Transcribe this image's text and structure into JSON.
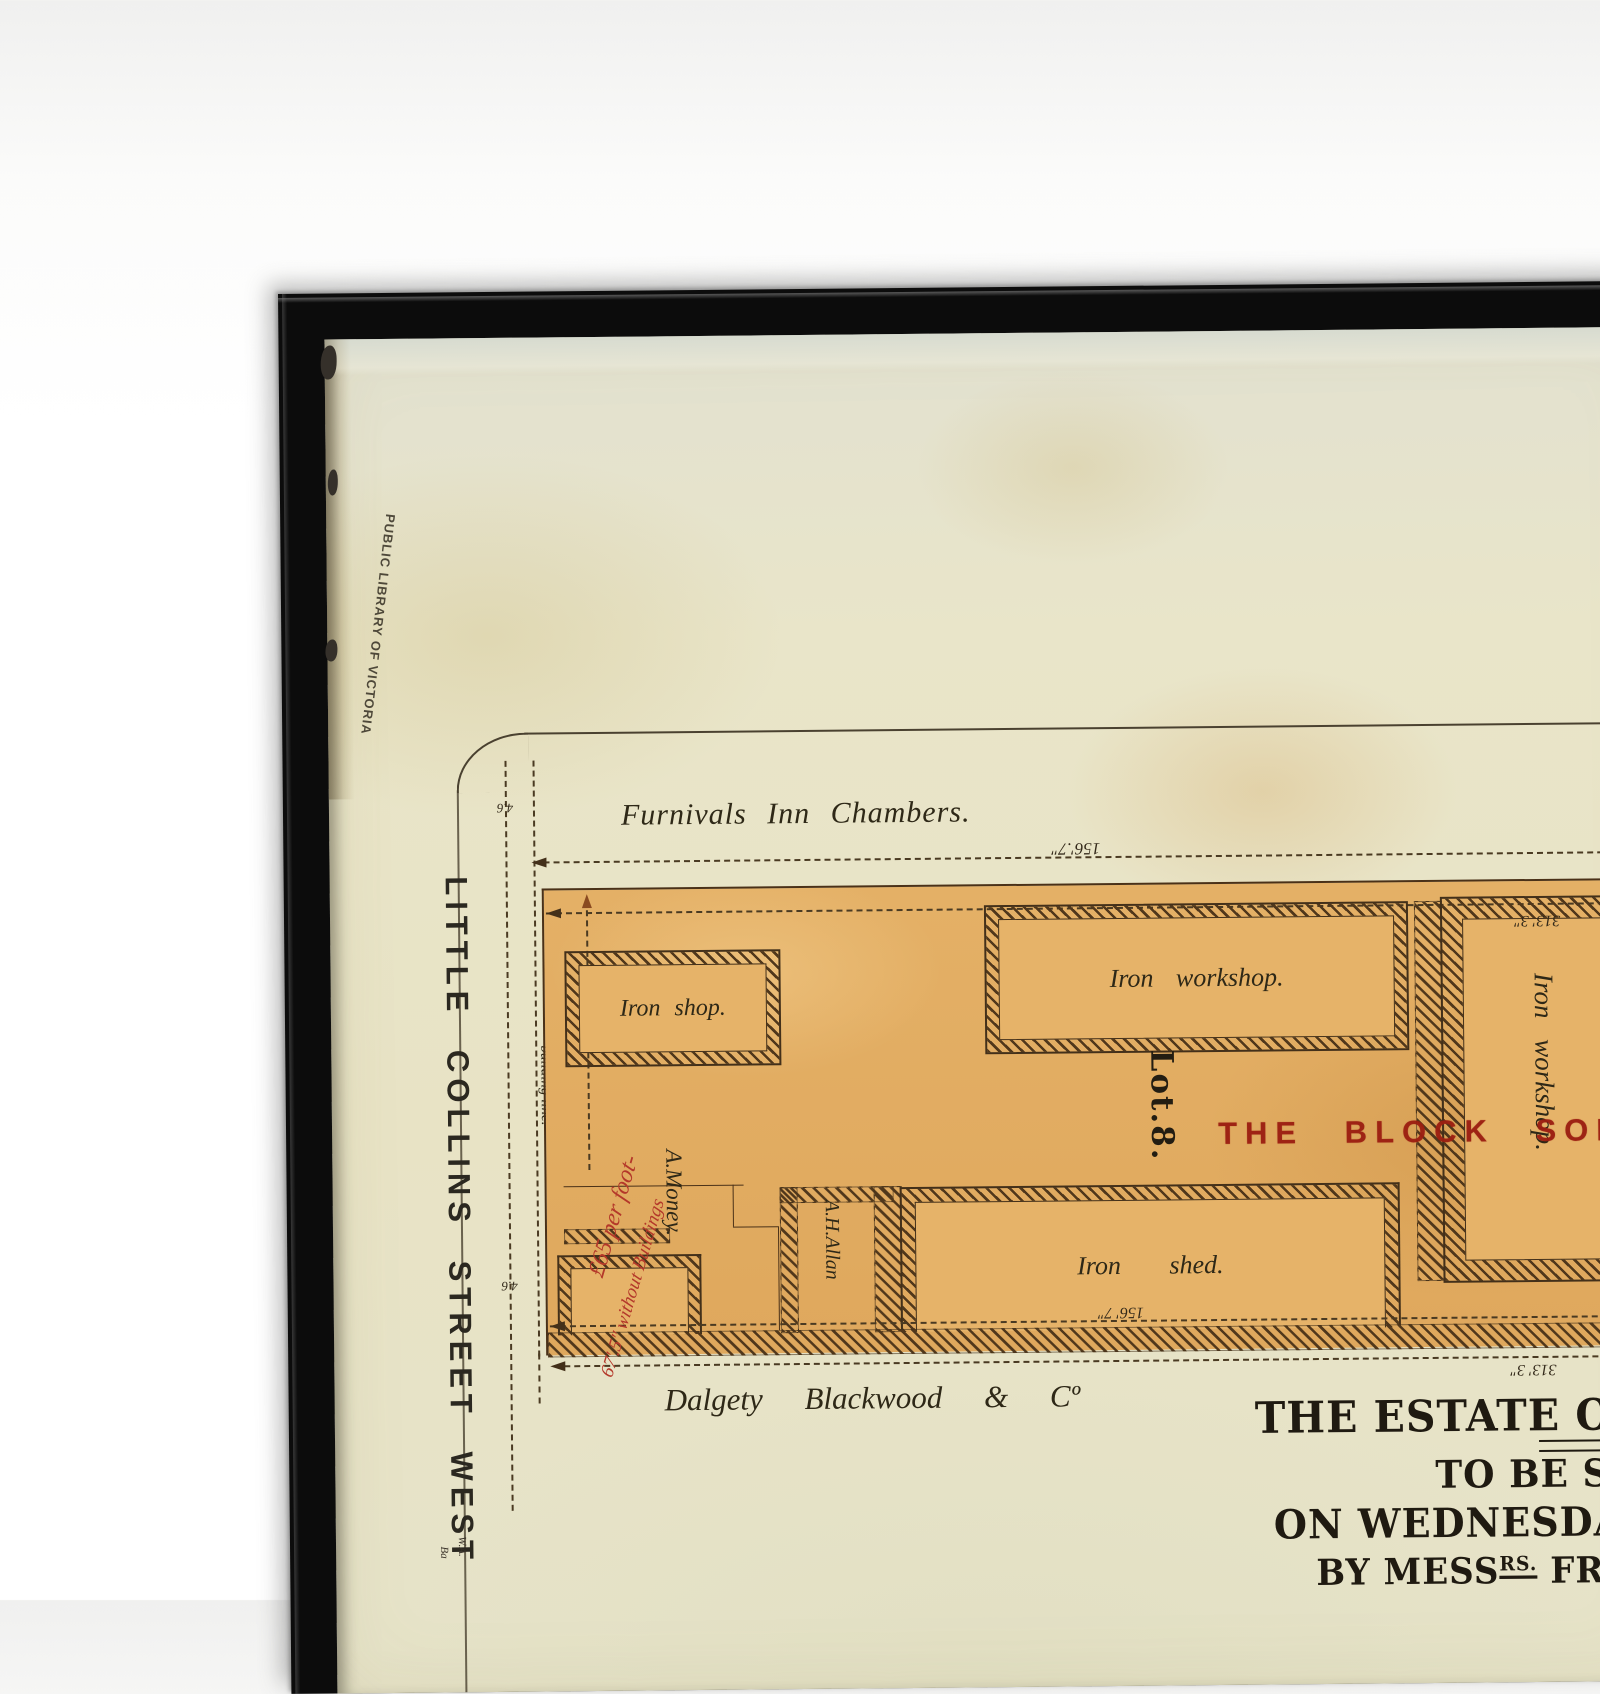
{
  "library_stamp": "PUBLIC LIBRARY OF VICTORIA",
  "streets": {
    "little_collins": "LITTLE COLLINS STREET WEST",
    "building_line": "building line."
  },
  "neighbors": {
    "top": "Furnivals Inn Chambers.",
    "bottom": "Dalgety Blackwood & Cº"
  },
  "lot": {
    "number": "Lot.8.",
    "sold_stamp": "THE BLOCK SOLD FOR",
    "occupant_money": "A.Money.",
    "occupant_allan": "A.H.Allan"
  },
  "buildings": {
    "iron_shop": "Iron shop.",
    "iron_workshop": "Iron workshop.",
    "iron_shed": "Iron shed.",
    "iron_workshop_right": "Iron workshop."
  },
  "dimensions": {
    "top_width": "156'.7″",
    "bottom_width": "156' 7″",
    "right_depth_top": "313' 3″",
    "right_depth_bottom": "313' 3″",
    "offset_top": "4.6",
    "offset_bottom": "4.6"
  },
  "annotations": {
    "price": "£65 per foot-",
    "frontage": "67'.5″ without Buildings"
  },
  "title": {
    "line1": "THE ESTATE OF THE",
    "line2": "TO BE SOL",
    "line3_pre": "ON WEDNESDAY 22",
    "line3_sup": "ND",
    "line3_post": "-",
    "line4_pre": "BY MESS",
    "line4_sup1": "RS.",
    "line4_mid": " FRASER & C",
    "line4_sup2": "O.",
    "line4_post": ", A"
  },
  "credit": {
    "line1": "W.A.",
    "line2": "Ba"
  },
  "colors": {
    "paper": "#e8e4c8",
    "block": "#e4b066",
    "ink": "#43301a",
    "red_stamp": "#a22314",
    "red_script": "#b4382a",
    "frame": "#0c0c0c"
  }
}
